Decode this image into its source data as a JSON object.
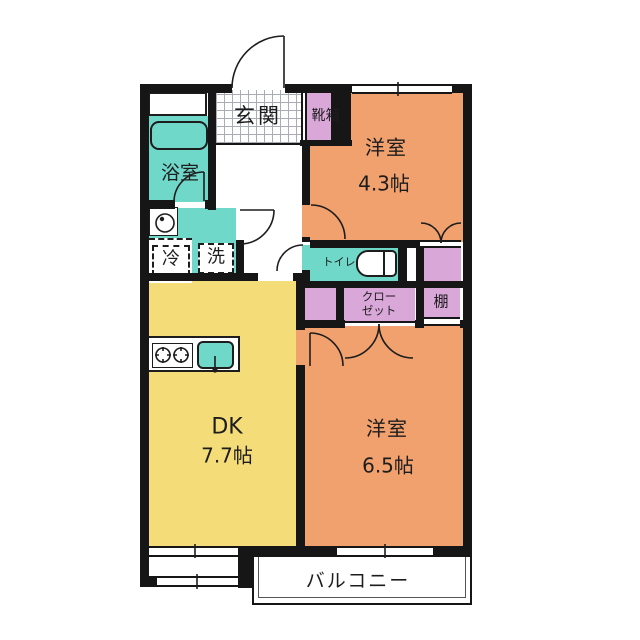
{
  "floorplan": {
    "kind": "apartment-floor-plan",
    "labels": {
      "entrance": "玄関",
      "shoe_box": "靴箱",
      "bathroom": "浴室",
      "fridge": "冷",
      "washer": "洗",
      "toilet": "トイレ",
      "closet_line1": "クロー",
      "closet_line2": "ゼット",
      "shelf": "棚",
      "room1_name": "洋室",
      "room1_size": "4.3帖",
      "dk_name": "DK",
      "dk_size": "7.7帖",
      "room2_name": "洋室",
      "room2_size": "6.5帖",
      "balcony": "バルコニー"
    },
    "colors": {
      "room_orange": "#f0a16e",
      "dk_yellow": "#f4dc79",
      "wet_area_teal": "#6fd8c9",
      "storage_pink": "#d9a7d8",
      "wall_black": "#161616",
      "tile_line_gray": "#a9adb3"
    }
  }
}
